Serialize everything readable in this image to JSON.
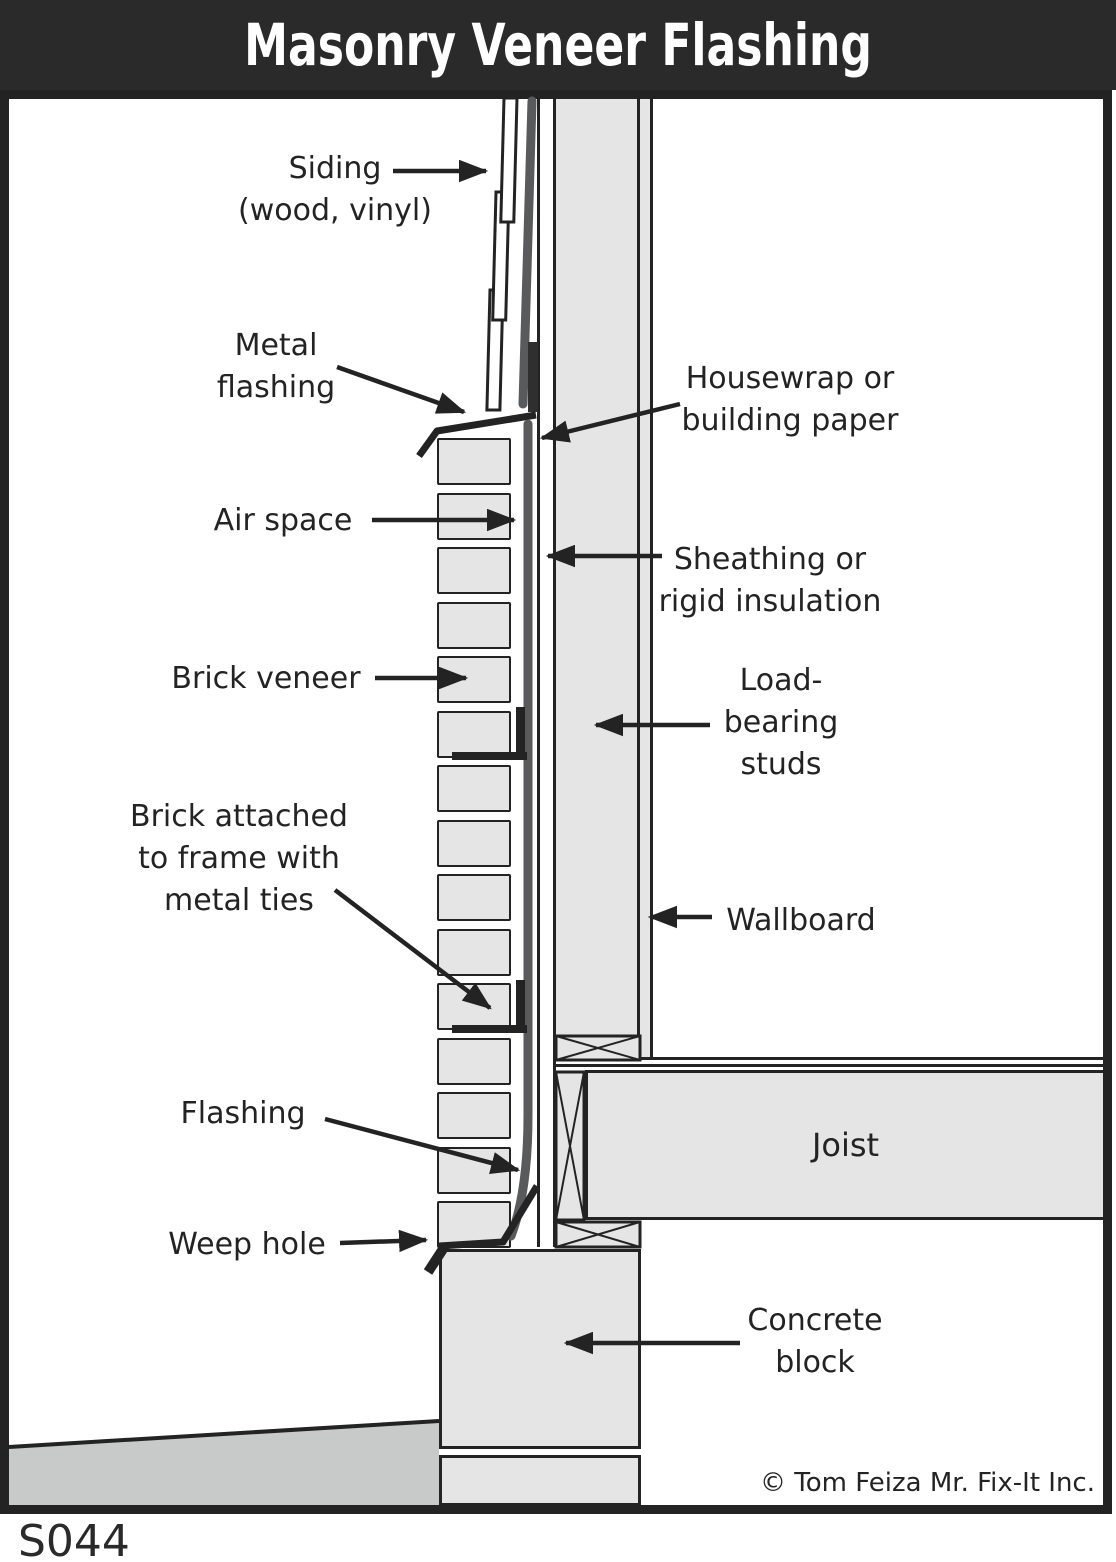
{
  "title": "Masonry Veneer Flashing",
  "figure_id": "S044",
  "copyright": "© Tom Feiza Mr. Fix-It Inc.",
  "labels": {
    "siding": [
      "Siding",
      "(wood, vinyl)"
    ],
    "metal_flashing": [
      "Metal",
      "flashing"
    ],
    "housewrap": [
      "Housewrap or",
      "building paper"
    ],
    "air_space": "Air space",
    "sheathing": [
      "Sheathing or",
      "rigid insulation"
    ],
    "brick_veneer": "Brick veneer",
    "load_bearing_studs": [
      "Load-",
      "bearing",
      "studs"
    ],
    "wallboard": "Wallboard",
    "metal_ties": [
      "Brick attached",
      "to frame with",
      "metal ties"
    ],
    "flashing": "Flashing",
    "weep_hole": "Weep hole",
    "joist": "Joist",
    "concrete_block": [
      "Concrete",
      "block"
    ]
  },
  "colors": {
    "band": "#2a2a2a",
    "ink": "#232323",
    "fill_light": "#e4e5e4",
    "fill_grade": "#c7cac8",
    "housewrap_gray": "#595a5c",
    "paper": "#ffffff"
  }
}
